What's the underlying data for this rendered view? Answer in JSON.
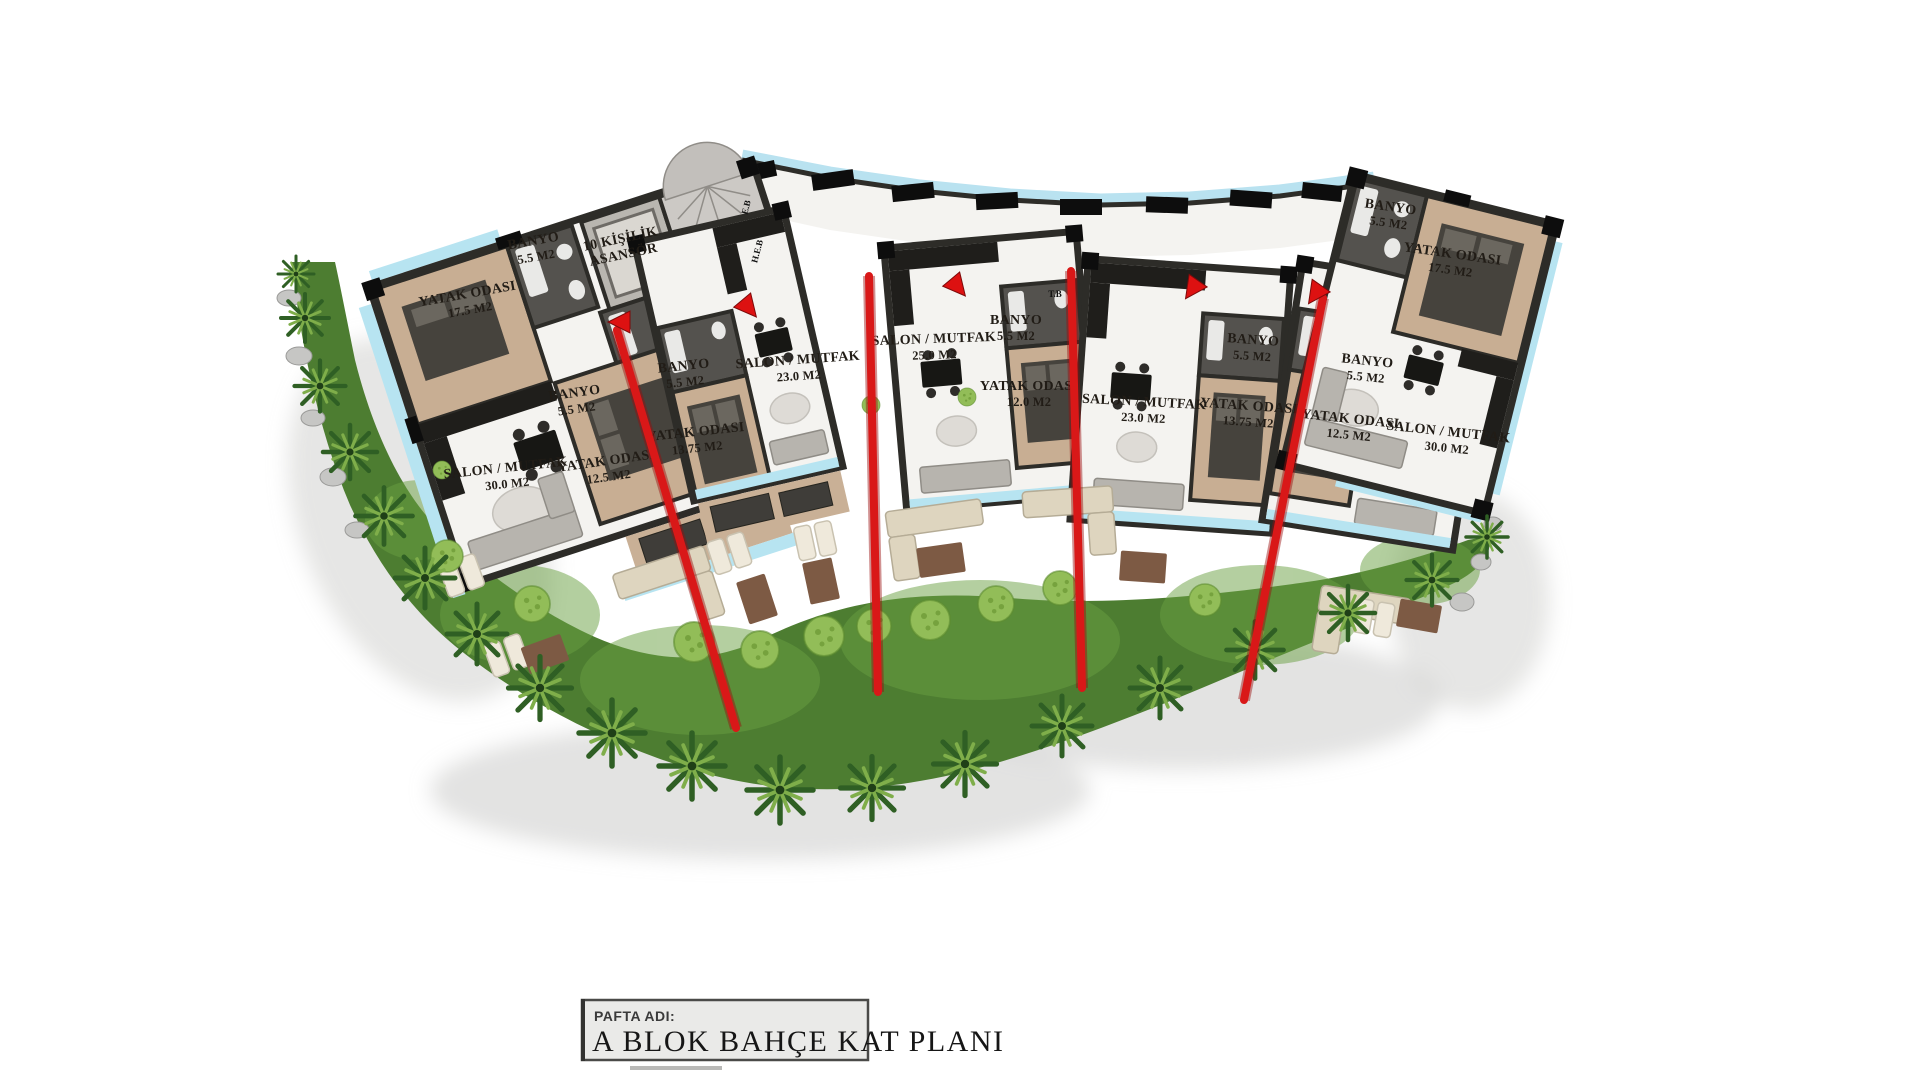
{
  "title_block": {
    "label": "PAFTA ADI:",
    "title": "A BLOK BAHÇE KAT PLANI"
  },
  "plan": {
    "rooms": [
      {
        "line1": "YATAK ODASI",
        "line2": "17.5 M2"
      },
      {
        "line1": "BANYO",
        "line2": "5.5 M2"
      },
      {
        "line1": "10 KİŞİLİK",
        "line2": "ASANSÖR"
      },
      {
        "line1": "BANYO",
        "line2": "5.5 M2"
      },
      {
        "line1": "YATAK ODASI",
        "line2": "12.5 M2"
      },
      {
        "line1": "SALON / MUTFAK",
        "line2": "30.0 M2"
      },
      {
        "line1": "BANYO",
        "line2": "5.5 M2"
      },
      {
        "line1": "YATAK ODASI",
        "line2": "13.75 M2"
      },
      {
        "line1": "SALON / MUTFAK",
        "line2": "23.0 M2"
      },
      {
        "line1": "SALON / MUTFAK",
        "line2": "25.0 M2"
      },
      {
        "line1": "BANYO",
        "line2": "5.5 M2"
      },
      {
        "line1": "YATAK ODASI",
        "line2": "12.0 M2"
      },
      {
        "line1": "SALON / MUTFAK",
        "line2": "23.0 M2"
      },
      {
        "line1": "BANYO",
        "line2": "5.5 M2"
      },
      {
        "line1": "YATAK ODASI",
        "line2": "13.75 M2"
      },
      {
        "line1": "BANYO",
        "line2": "5.5 M2"
      },
      {
        "line1": "YATAK ODASI",
        "line2": "12.5 M2"
      },
      {
        "line1": "SALON / MUTFAK",
        "line2": "30.0 M2"
      },
      {
        "line1": "BANYO",
        "line2": "5.5 M2"
      },
      {
        "line1": "YATAK ODASI",
        "line2": "17.5 M2"
      }
    ],
    "small_labels": [
      {
        "text": "T.B"
      },
      {
        "text": "E.B"
      },
      {
        "text": "H.E.B"
      }
    ],
    "colors": {
      "wall": "#2d2c28",
      "marble": "#f4f3f0",
      "bedroom_floor": "#c8ae93",
      "balcony": "#b7e4f1",
      "grass": "#4d7d31",
      "grass_light": "#69a041",
      "palm_dark": "#2f5f24",
      "palm_light": "#7fae4a",
      "section_red": "#d91818",
      "deck": "#c9b096",
      "title_bg": "#eaeae8"
    }
  }
}
